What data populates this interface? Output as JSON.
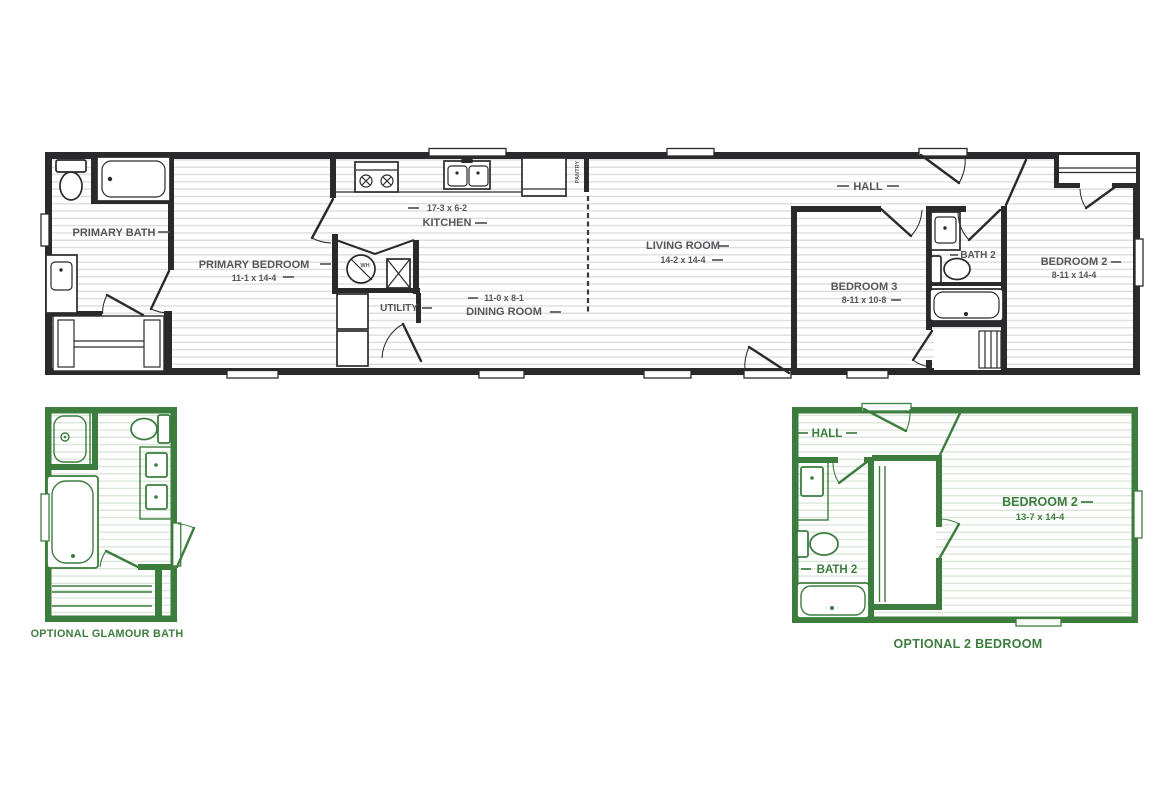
{
  "main_plan": {
    "primary_bath": {
      "name": "PRIMARY BATH"
    },
    "primary_bedroom": {
      "name": "PRIMARY BEDROOM",
      "dim": "11-1 x 14-4"
    },
    "kitchen": {
      "name": "KITCHEN",
      "dim": "17-3 x 6-2"
    },
    "utility": {
      "name": "UTILITY"
    },
    "pantry": {
      "name": "PANTRY"
    },
    "dining_room": {
      "name": "DINING ROOM",
      "dim": "11-0 x 8-1"
    },
    "living_room": {
      "name": "LIVING ROOM",
      "dim": "14-2 x 14-4"
    },
    "hall": {
      "name": "HALL"
    },
    "bedroom_3": {
      "name": "BEDROOM 3",
      "dim": "8-11 x 10-8"
    },
    "bath_2": {
      "name": "BATH 2"
    },
    "bedroom_2": {
      "name": "BEDROOM 2",
      "dim": "8-11 x 14-4"
    },
    "water_heater": {
      "label": "WH"
    }
  },
  "optional_glamour_bath": {
    "caption": "OPTIONAL GLAMOUR BATH"
  },
  "optional_2_bedroom": {
    "caption": "OPTIONAL 2 BEDROOM",
    "hall": {
      "name": "HALL"
    },
    "bath_2": {
      "name": "BATH 2"
    },
    "bedroom_2": {
      "name": "BEDROOM 2",
      "dim": "13-7 x 14-4"
    }
  },
  "colors": {
    "plan_ink": "#2a2a2d",
    "optional_green": "#3c7d3e",
    "label_gray": "#55565a",
    "floor_line": "#dadbdd"
  }
}
